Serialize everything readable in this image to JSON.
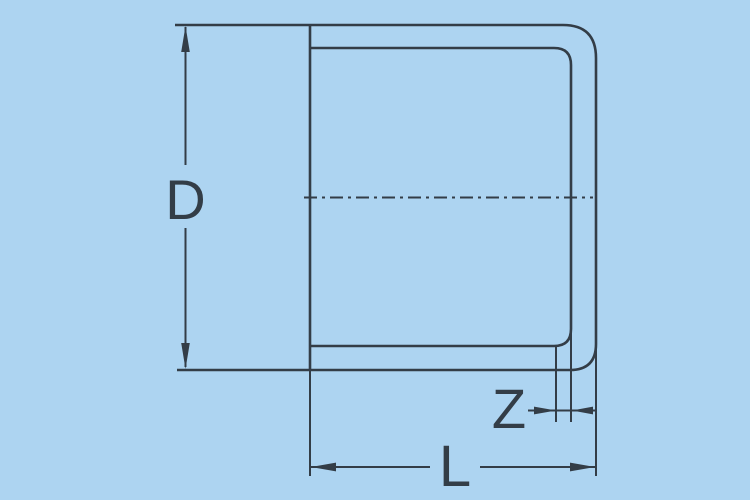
{
  "diagram": {
    "dimension_labels": {
      "diameter": "D",
      "end_offset": "Z",
      "length": "L"
    },
    "colors": {
      "background": "#ADD4F1",
      "line": "#333D47"
    }
  }
}
